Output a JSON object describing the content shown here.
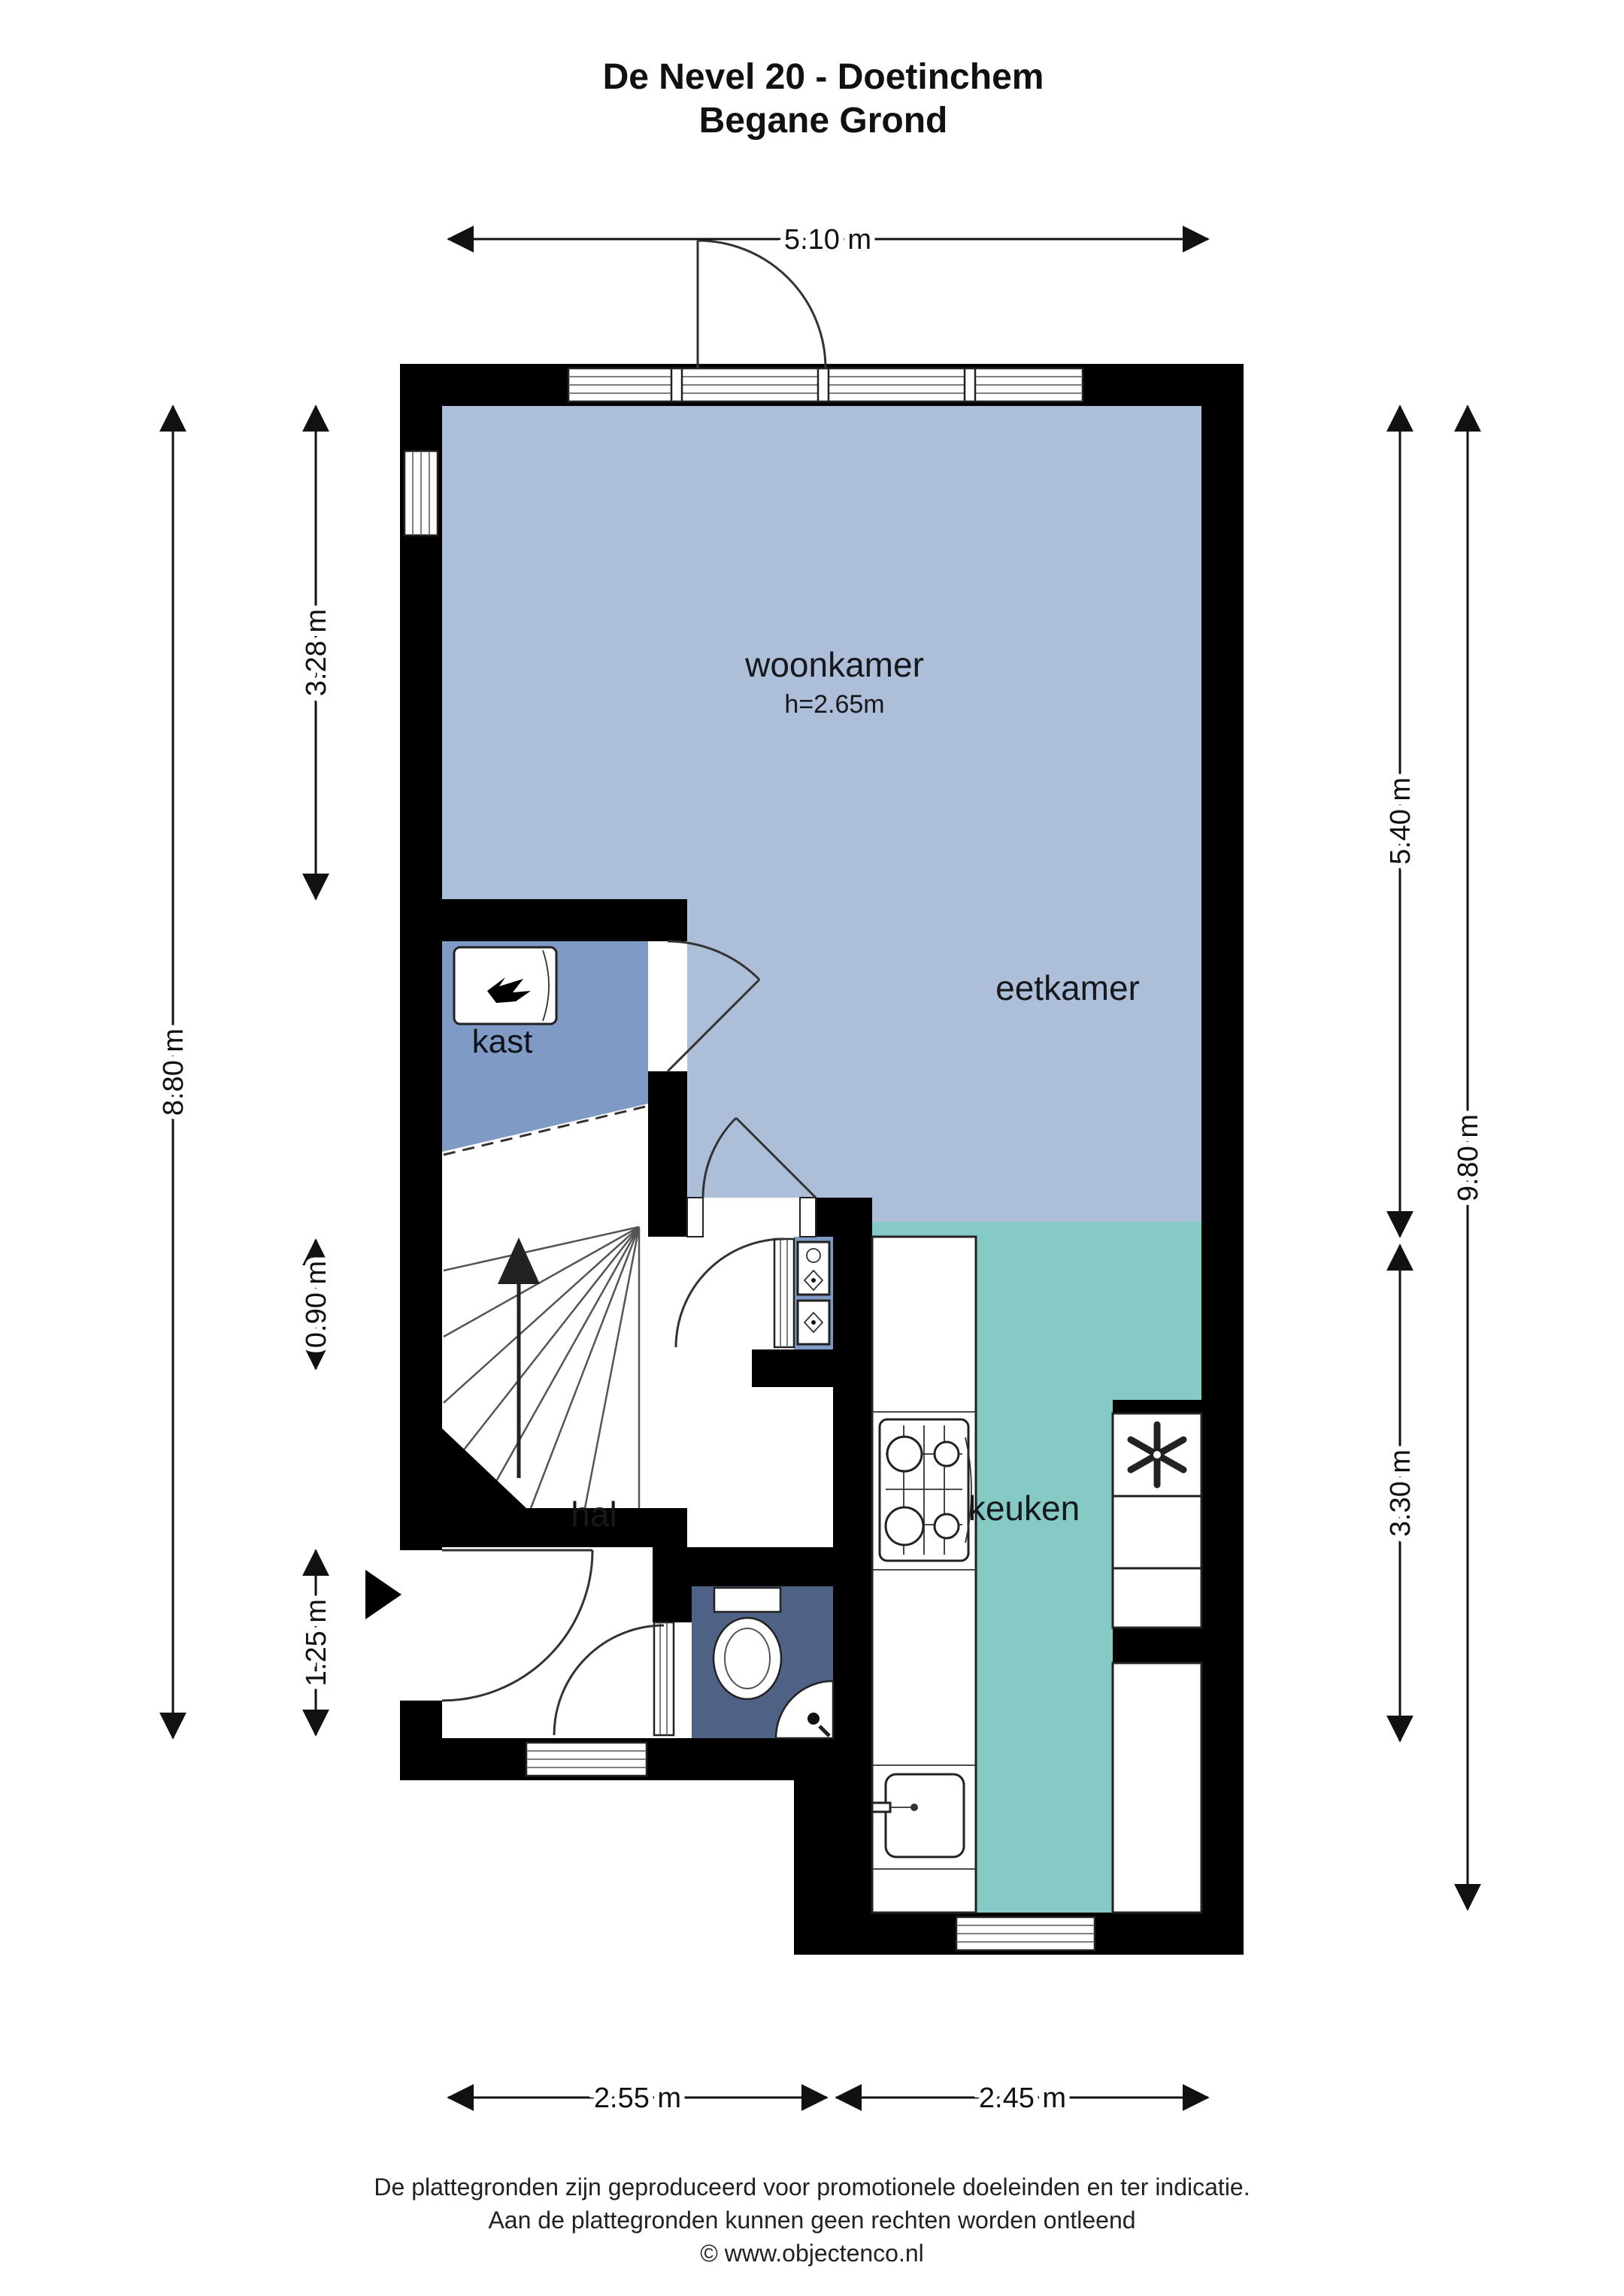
{
  "title": {
    "line1": "De Nevel 20 - Doetinchem",
    "line2": "Begane Grond"
  },
  "rooms": {
    "woonkamer": {
      "label": "woonkamer",
      "height_note": "h=2.65m"
    },
    "eetkamer": {
      "label": "eetkamer"
    },
    "kast": {
      "label": "kast"
    },
    "hal": {
      "label": "hal"
    },
    "keuken": {
      "label": "keuken"
    }
  },
  "dimensions": {
    "top_width": {
      "label": "5.10 m"
    },
    "left_upper": {
      "label": "3.28 m"
    },
    "left_total": {
      "label": "8.80 m"
    },
    "left_mid": {
      "label": "0.90 m"
    },
    "left_lower": {
      "label": "1.25 m"
    },
    "right_upper": {
      "label": "5.40 m"
    },
    "right_total": {
      "label": "9.80 m"
    },
    "right_lower": {
      "label": "3.30 m"
    },
    "bottom_left": {
      "label": "2.55 m"
    },
    "bottom_right": {
      "label": "2.45 m"
    }
  },
  "fixtures": {
    "boiler": "boiler-flame-icon",
    "stove": "gas-stove-icon",
    "kitchen_sink": "kitchen-sink-icon",
    "toilet": "toilet-icon",
    "corner_sink": "corner-sink-icon",
    "ventilation": "ventilation-fan-icon",
    "meters": "meter-cupboard-icons",
    "stair_arrow": "stairs-up-arrow-icon",
    "entrance": "entrance-arrow-icon"
  },
  "colors": {
    "living": "#adbed8",
    "closet": "#7f9ac4",
    "kitchen": "#85cac4",
    "toilet": "#4f6286",
    "wall": "#000000"
  },
  "footer": {
    "line1": "De plattegronden zijn geproduceerd voor promotionele doeleinden en ter indicatie.",
    "line2": "Aan de plattegronden kunnen geen rechten worden ontleend",
    "line3": "© www.objectenco.nl"
  }
}
